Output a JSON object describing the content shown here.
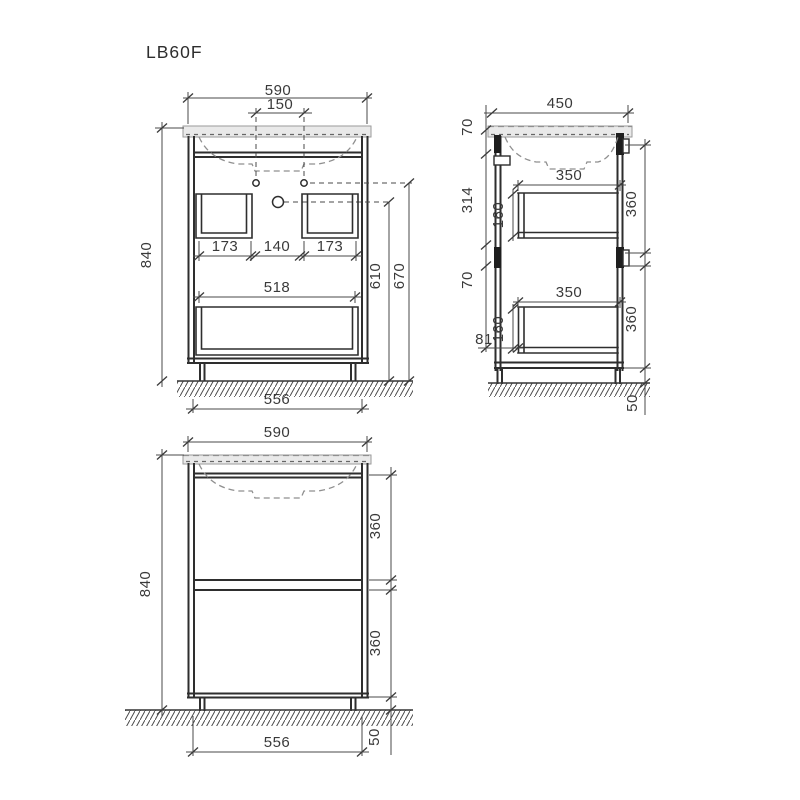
{
  "title": "LB60F",
  "drawing": {
    "front_open": {
      "dims": {
        "overall_width": "590",
        "faucet_hole_spacing": "150",
        "overall_height": "840",
        "left_drawer_opening_width": "173",
        "center_gap_width": "140",
        "right_drawer_opening_width": "173",
        "bottom_drawer_opening_width": "518",
        "drain_center_height": "610",
        "faucet_hole_height": "670",
        "base_width": "556"
      }
    },
    "side": {
      "dims": {
        "overall_depth": "450",
        "countertop_apron_height": "70",
        "upper_cavity_height": "314",
        "upper_drawer_depth": "350",
        "upper_drawer_box_height": "160",
        "upper_drawer_front_height": "360",
        "mid_gap_height": "70",
        "lower_drawer_depth": "350",
        "lower_drawer_box_height": "160",
        "lower_drawer_back_offset": "81",
        "lower_drawer_front_height": "360",
        "plinth_height": "50"
      }
    },
    "front_closed": {
      "dims": {
        "overall_width": "590",
        "overall_height": "840",
        "upper_drawer_front_height": "360",
        "lower_drawer_front_height": "360",
        "base_width": "556",
        "plinth_height": "50"
      }
    }
  },
  "colors": {
    "line_heavy": "#2e2e2e",
    "line_dim": "#4a4a4a",
    "hidden_line": "#8f8f8f",
    "countertop_fill": "#e9e9e9",
    "background": "#ffffff"
  }
}
